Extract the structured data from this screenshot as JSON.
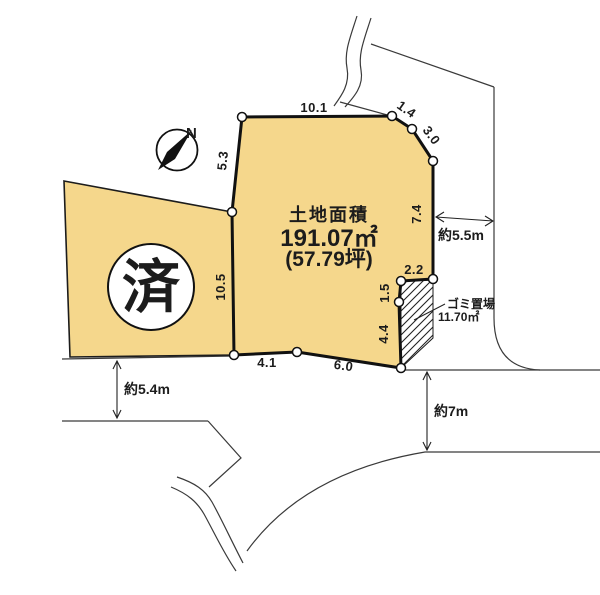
{
  "parcel": {
    "area_label": "土地面積",
    "area_sqm": "191.07㎡",
    "area_tsubo": "(57.79坪)",
    "edges": {
      "top": "10.1",
      "top_right_a": "1.4",
      "top_right_b": "3.0",
      "right": "7.4",
      "notch_top": "2.2",
      "notch_mid": "1.5",
      "notch_bottom": "4.4",
      "bottom_right": "6.0",
      "bottom_left": "4.1",
      "left_lower": "10.5",
      "left_upper": "5.3"
    }
  },
  "adjacent_parcel": {
    "status": "済"
  },
  "garbage_area": {
    "name": "ゴミ置場",
    "area": "11.70㎡"
  },
  "roads": {
    "west_width": "約5.4m",
    "east_width": "約5.5m",
    "south_width": "約7m"
  },
  "compass": {
    "north": "N"
  },
  "colors": {
    "parcel_fill": "#F5D78C",
    "outline": "#1c1c1c",
    "background": "#FFFFFF"
  }
}
